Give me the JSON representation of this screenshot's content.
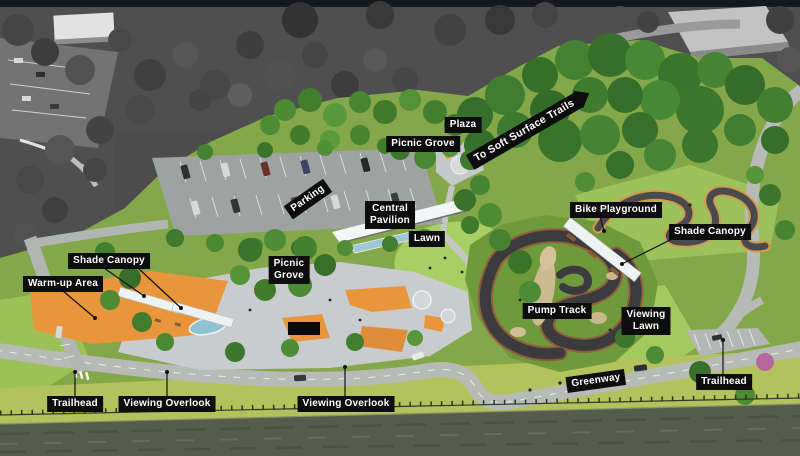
{
  "colors": {
    "label_bg": "#0d0d0d",
    "label_text": "#ffffff",
    "context_gray": "#4c4c4c",
    "park_green": "#84a74a",
    "lawn_green": "#a8cf63",
    "forest_green": "#3f7a2f",
    "concrete": "#c8ccce",
    "accent_orange": "#e8953c",
    "asphalt_track": "#3b3b3e",
    "track_red_edge": "#9c4a3d",
    "sand": "#cdbb90",
    "canopy_white": "#eff2f3",
    "water": "#565b4c",
    "bank_grass": "#b2c25c"
  },
  "labels": {
    "plaza": {
      "text": "Plaza"
    },
    "picnic_grove_north": {
      "text": "Picnic Grove"
    },
    "to_soft_surface_trails": {
      "text": "To Soft Surface Trails"
    },
    "parking": {
      "text": "Parking"
    },
    "central_pavilion": {
      "text": "Central\nPavilion"
    },
    "lawn": {
      "text": "Lawn"
    },
    "bike_playground": {
      "text": "Bike Playground"
    },
    "shade_canopy_east": {
      "text": "Shade Canopy"
    },
    "shade_canopy_west": {
      "text": "Shade Canopy"
    },
    "warm_up_area": {
      "text": "Warm-up Area"
    },
    "picnic_grove_center": {
      "text": "Picnic\nGrove"
    },
    "pump_track": {
      "text": "Pump Track"
    },
    "viewing_lawn": {
      "text": "Viewing\nLawn"
    },
    "greenway": {
      "text": "Greenway"
    },
    "trailhead_east": {
      "text": "Trailhead"
    },
    "trailhead_west": {
      "text": "Trailhead"
    },
    "viewing_overlook_west": {
      "text": "Viewing Overlook"
    },
    "viewing_overlook_center": {
      "text": "Viewing Overlook"
    }
  }
}
